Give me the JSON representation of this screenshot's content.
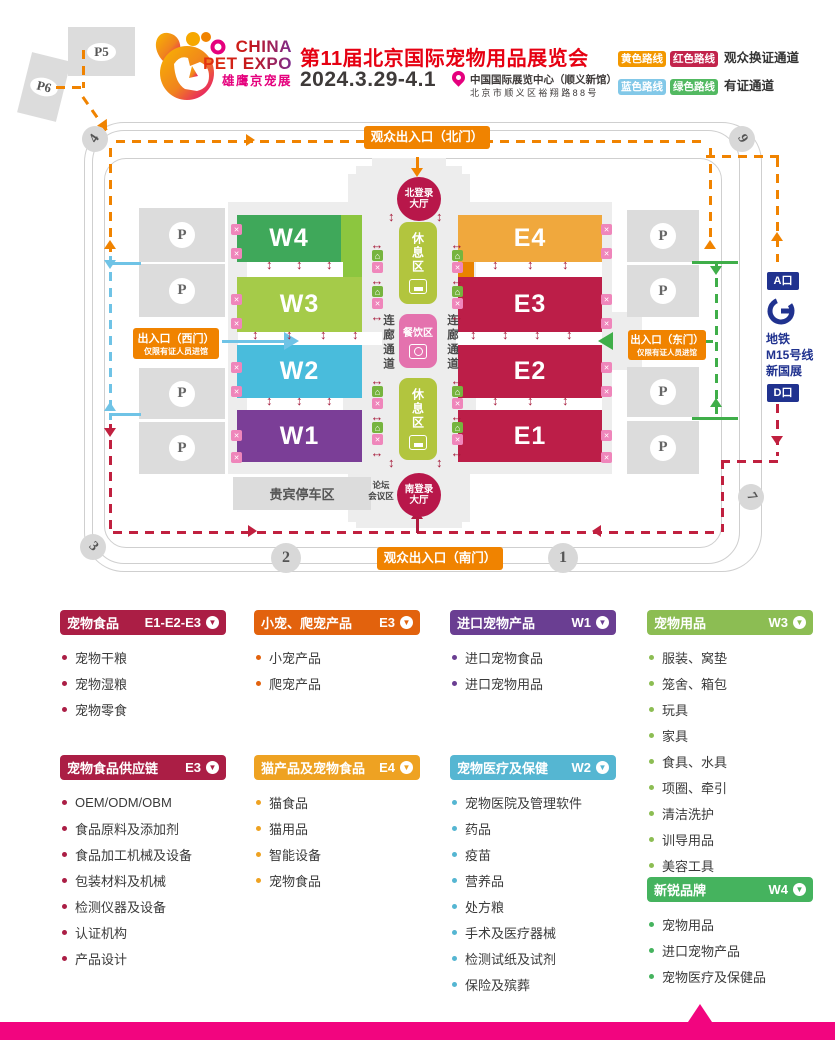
{
  "header": {
    "logo": {
      "line1": "CHINA",
      "line2": "PET EXPO",
      "line3": "雄鹰京宠展"
    },
    "title": "第11届北京国际宠物用品展览会",
    "date": "2024.3.29-4.1",
    "venue_line1": "中国国际展览中心（顺义新馆）",
    "venue_line2": "北京市顺义区裕翔路88号",
    "legend": {
      "badge_yellow": "黄色路线",
      "badge_red": "红色路线",
      "row1_label": "观众换证通道",
      "badge_blue": "蓝色路线",
      "badge_green": "绿色路线",
      "row2_label": "有证通道",
      "colors": {
        "yellow": "#f39800",
        "red": "#c2244c",
        "blue": "#82c8e8",
        "green": "#52b961"
      }
    }
  },
  "map": {
    "north_gate": "观众出入口（北门）",
    "south_gate": "观众出入口（南门）",
    "west_gate_line1": "出入口（西门）",
    "west_gate_line2": "仅限有证人员进馆",
    "east_gate_line1": "出入口（东门）",
    "east_gate_line2": "仅限有证人员进馆",
    "north_lobby_line1": "北登录",
    "north_lobby_line2": "大厅",
    "south_lobby_line1": "南登录",
    "south_lobby_line2": "大厅",
    "rest_area": "休息区",
    "dining_area": "餐饮区",
    "corridor": "连廊通道",
    "vip_parking": "贵宾停车区",
    "forum_line1": "论坛",
    "forum_line2": "会议区",
    "parking_letter": "P",
    "p5": "P5",
    "p6": "P6",
    "gate_numbers": {
      "g1": "1",
      "g2": "2",
      "g3": "3",
      "g4": "4",
      "g7": "7",
      "g9": "9"
    },
    "metro": {
      "a_exit": "A口",
      "d_exit": "D口",
      "line1": "地铁",
      "line2": "M15号线",
      "line3": "新国展"
    },
    "halls_west": [
      {
        "id": "W4",
        "color": "#3fa85a"
      },
      {
        "id": "W3",
        "color": "#a5cb49"
      },
      {
        "id": "W2",
        "color": "#49bcdc"
      },
      {
        "id": "W1",
        "color": "#7b3e97"
      }
    ],
    "halls_east": [
      {
        "id": "E4",
        "color": "#f0a83d"
      },
      {
        "id": "E3",
        "color": "#bc1e48"
      },
      {
        "id": "E2",
        "color": "#bc1e48"
      },
      {
        "id": "E1",
        "color": "#bc1e48"
      }
    ],
    "route_colors": {
      "yellow": "#f08300",
      "red": "#c0203f",
      "blue": "#6fc3e6",
      "green": "#3fae49"
    }
  },
  "icons": {
    "arrow_v": "↕",
    "arrow_h": "↔",
    "home": "⌂",
    "cross": "✕",
    "pointer": "▼"
  },
  "categories": [
    {
      "title": "宠物食品",
      "zone": "E1-E2-E3",
      "color": "#ab1e45",
      "items": [
        "宠物干粮",
        "宠物湿粮",
        "宠物零食"
      ]
    },
    {
      "title": "宠物食品供应链",
      "zone": "E3",
      "color": "#ab1e45",
      "items": [
        "OEM/ODM/OBM",
        "食品原料及添加剂",
        "食品加工机械及设备",
        "包装材料及机械",
        "检测仪器及设备",
        "认证机构",
        "产品设计"
      ]
    },
    {
      "title": "小宠、爬宠产品",
      "zone": "E3",
      "color": "#e2620d",
      "items": [
        "小宠产品",
        "爬宠产品"
      ]
    },
    {
      "title": "猫产品及宠物食品",
      "zone": "E4",
      "color": "#eea222",
      "items": [
        "猫食品",
        "猫用品",
        "智能设备",
        "宠物食品"
      ]
    },
    {
      "title": "进口宠物产品",
      "zone": "W1",
      "color": "#6a3e92",
      "items": [
        "进口宠物食品",
        "进口宠物用品"
      ]
    },
    {
      "title": "宠物医疗及保健",
      "zone": "W2",
      "color": "#55b6d2",
      "items": [
        "宠物医院及管理软件",
        "药品",
        "疫苗",
        "营养品",
        "处方粮",
        "手术及医疗器械",
        "检测试纸及试剂",
        "保险及殡葬"
      ]
    },
    {
      "title": "宠物用品",
      "zone": "W3",
      "color": "#8cbd53",
      "items": [
        "服装、窝垫",
        "笼舍、箱包",
        "玩具",
        "家具",
        "食具、水具",
        "项圈、牵引",
        "清洁洗护",
        "训导用品",
        "美容工具"
      ]
    },
    {
      "title": "新锐品牌",
      "zone": "W4",
      "color": "#45b35e",
      "items": [
        "宠物用品",
        "进口宠物产品",
        "宠物医疗及保健品"
      ]
    }
  ],
  "footer": {
    "bar_color": "#f2057f"
  }
}
